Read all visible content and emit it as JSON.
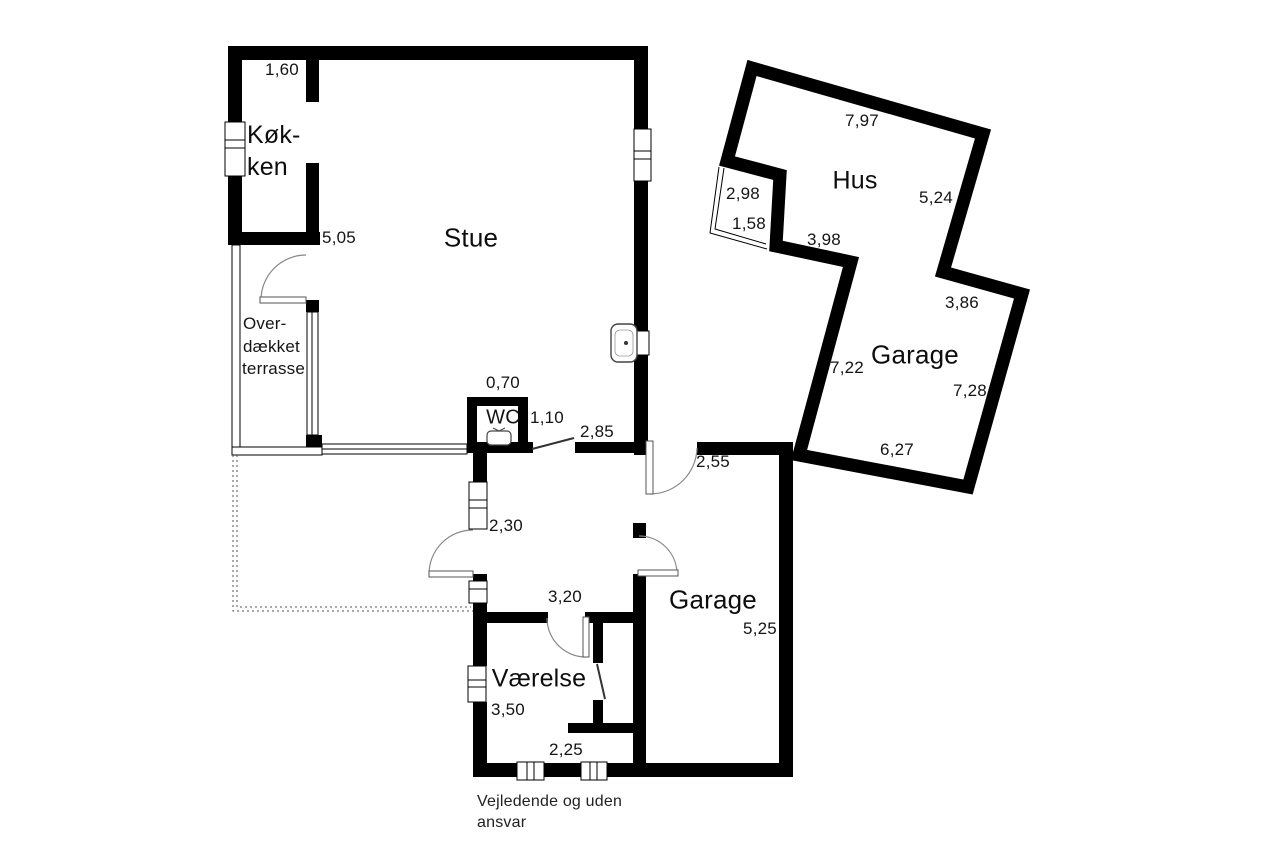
{
  "colors": {
    "wall": "#000000",
    "text": "#141414",
    "door_arc": "#888888"
  },
  "main_building": {
    "rooms": {
      "kitchen_line1": "Køk-",
      "kitchen_line2": "ken",
      "living_room": "Stue",
      "terrace_line1": "Over-",
      "terrace_line2": "dækket",
      "terrace_line3": "terrasse",
      "wc": "WC"
    },
    "dimensions": {
      "d160": "1,60",
      "d505": "5,05",
      "d070": "0,70",
      "d110": "1,10",
      "d285": "2,85"
    }
  },
  "lower_building": {
    "rooms": {
      "garage": "Garage",
      "bedroom": "Værelse"
    },
    "dimensions": {
      "d255": "2,55",
      "d230": "2,30",
      "d320": "3,20",
      "d525": "5,25",
      "d350": "3,50",
      "d225": "2,25"
    }
  },
  "rotated_building": {
    "rooms": {
      "house": "Hus",
      "garage": "Garage"
    },
    "dimensions": {
      "d797": "7,97",
      "d524": "5,24",
      "d298": "2,98",
      "d158": "1,58",
      "d398": "3,98",
      "d386": "3,86",
      "d722": "7,22",
      "d728": "7,28",
      "d627": "6,27"
    }
  },
  "footer": {
    "disclaimer_line1": "Vejledende og uden",
    "disclaimer_line2": "ansvar"
  }
}
